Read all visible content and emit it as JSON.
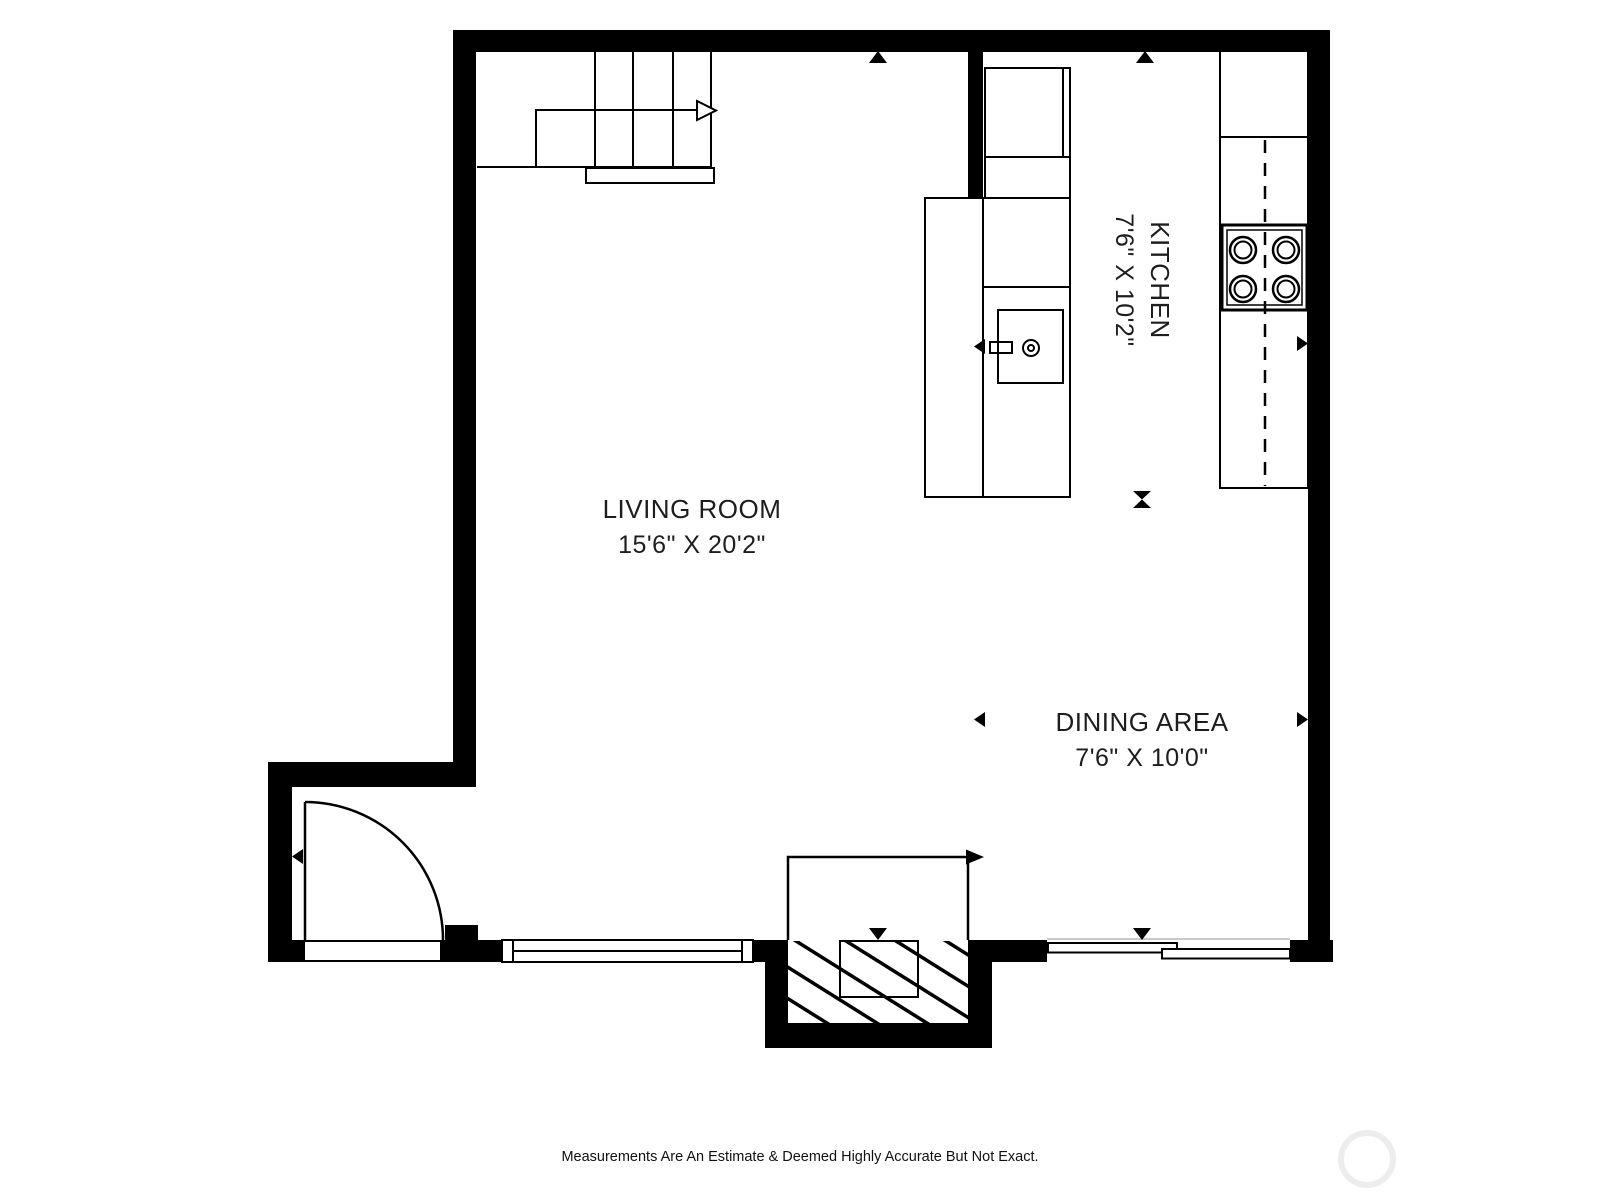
{
  "floor_plan": {
    "rooms": [
      {
        "name": "LIVING ROOM",
        "dimensions": "15'6\" X 20'2\""
      },
      {
        "name": "KITCHEN",
        "dimensions": "7'6\" X 10'2\""
      },
      {
        "name": "DINING AREA",
        "dimensions": "7'6\" X 10'0\""
      }
    ],
    "disclaimer": "Measurements Are An Estimate & Deemed Highly Accurate But Not Exact.",
    "colors": {
      "wall": "#000000",
      "line": "#000000",
      "text": "#1d1d1d",
      "opening_line": "#c9c9c9",
      "watermark": "#ededed"
    }
  }
}
